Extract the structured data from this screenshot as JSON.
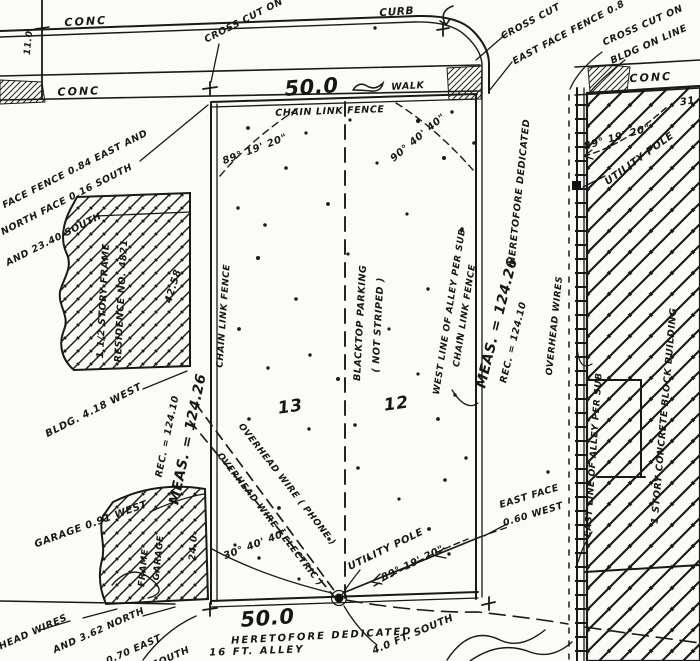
{
  "labels": {
    "street": {
      "conc_top": "CONC",
      "cross_cut_on": "CROSS CUT ON",
      "curb": "CURB",
      "front_dim": "50.0",
      "walk": "WALK",
      "conc_walk": "CONC",
      "offset_11": "11.0"
    },
    "west": {
      "fence_note_1": "WEST FACE FENCE 0.84 EAST AND",
      "fence_note_2": "NORTH FACE 0.16 SOUTH",
      "south_2340": "AND 23.40 SOUTH",
      "house_line1": "1 1/2 STORY FRAME",
      "house_line2": "RESIDENCE NO. 4821",
      "house_dim": "42.58",
      "bldg_west": "BLDG. 4.18 WEST",
      "rec": "REC. = 124.10",
      "meas": "MEAS. = 124.26",
      "garage_west": "GARAGE 0.91 WEST",
      "frame": "FRAME",
      "garage": "GARAGE",
      "garage_dim": "24.0"
    },
    "parcel": {
      "chain_link_top": "CHAIN LINK FENCE",
      "chain_link_west": "CHAIN LINK FENCE",
      "angle_nw": "89° 19' 20\"",
      "angle_ne": "90° 40' 40\"",
      "angle_sw": "30° 40' 40\"",
      "angle_se": "89° 19' 20\"",
      "lot_13": "13",
      "lot_12": "12",
      "blacktop_1": "BLACKTOP PARKING",
      "blacktop_2": "( NOT STRIPED )",
      "oh_phone": "OVERHEAD WIRE ( PHONE )",
      "oh_electric": "OVERHEAD WIRE ( ELECTRIC )",
      "utility_pole": "UTILITY POLE"
    },
    "alley": {
      "west_line": "WEST LINE OF ALLEY PER SUB",
      "chain_link": "CHAIN LINK FENCE",
      "heretofore": "HERETOFORE DEDICATED",
      "meas": "MEAS. = 124.26",
      "rec": "REC. = 124.10",
      "oh_wires": "OVERHEAD WIRES",
      "east_line": "EAST LINE OF ALLEY PER SUB",
      "east_face_1": "EAST FACE",
      "east_face_2": "0.60 WEST"
    },
    "east": {
      "cross_cut": "CROSS CUT",
      "fence_note": "EAST FACE FENCE 0.8",
      "cross_cut_on": "CROSS CUT ON",
      "bldg_on_line": "BLDG ON LINE",
      "conc": "CONC",
      "dim_31": "31.",
      "angle": "89° 19' 20\"",
      "utility_pole": "UTILITY POLE",
      "building": "1 STORY CONCRETE BLOCK BUILDING"
    },
    "south": {
      "dim_50": "50.0",
      "heretofore": "HERETOFORE DEDICATED",
      "alley_16": "16 FT. ALLEY",
      "ft_south": "4.0 FT. SOUTH",
      "oh_wires": "OVERHEAD WIRES",
      "north_362": "AND 3.62 NORTH",
      "east_070": "0.70 EAST",
      "south_clip": "SOUTH"
    }
  },
  "ink_color": "#191919",
  "paper_color": "#fbfbf8"
}
